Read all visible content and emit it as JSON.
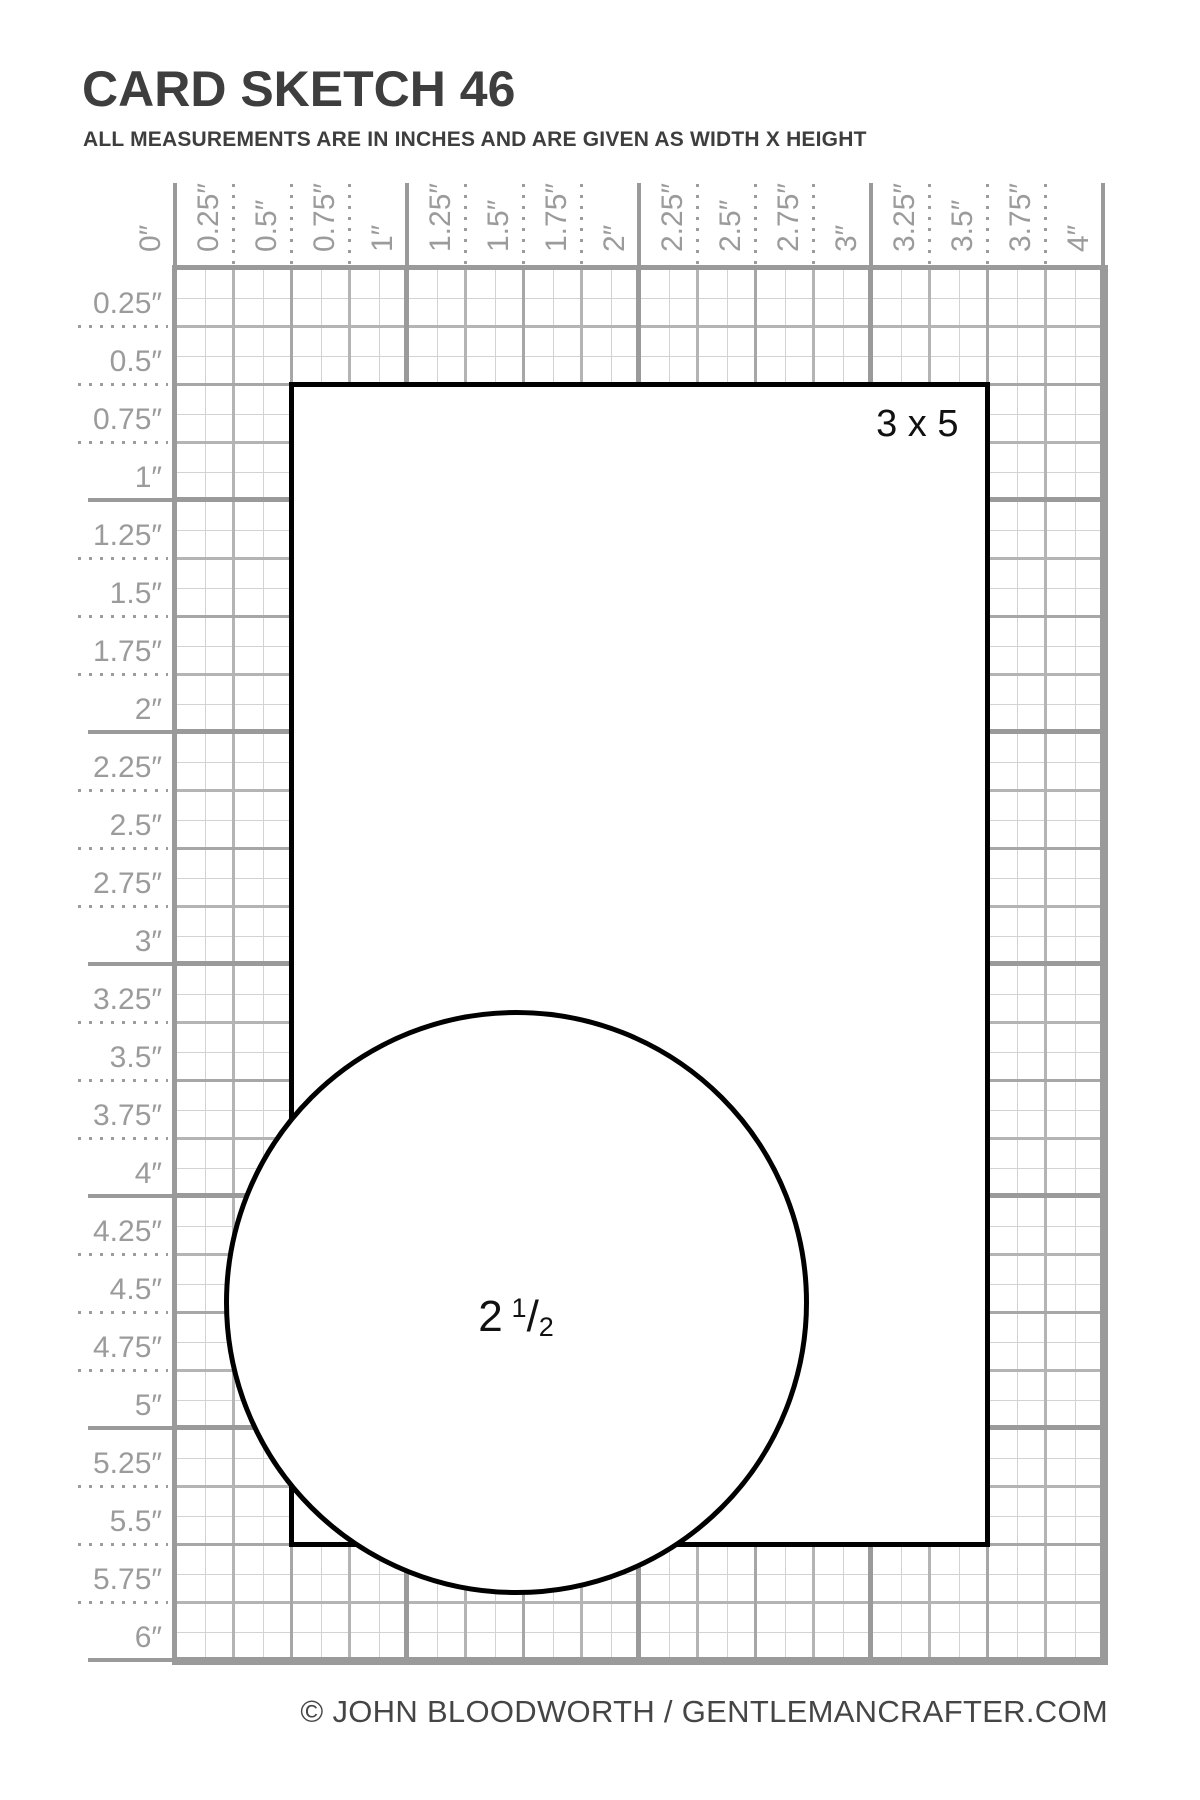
{
  "title": "CARD SKETCH 46",
  "subtitle": "ALL MEASUREMENTS ARE IN INCHES AND ARE GIVEN AS WIDTH X HEIGHT",
  "footer": "© JOHN BLOODWORTH / GENTLEMANCRAFTER.COM",
  "ruler": {
    "unit": "inches",
    "top_labels": [
      "0″",
      "0.25″",
      "0.5″",
      "0.75″",
      "1″",
      "1.25″",
      "1.5″",
      "1.75″",
      "2″",
      "2.25″",
      "2.5″",
      "2.75″",
      "3″",
      "3.25″",
      "3.5″",
      "3.75″",
      "4″"
    ],
    "left_labels": [
      "0.25″",
      "0.5″",
      "0.75″",
      "1″",
      "1.25″",
      "1.5″",
      "1.75″",
      "2″",
      "2.25″",
      "2.5″",
      "2.75″",
      "3″",
      "3.25″",
      "3.5″",
      "3.75″",
      "4″",
      "4.25″",
      "4.5″",
      "4.75″",
      "5″",
      "5.25″",
      "5.5″",
      "5.75″",
      "6″"
    ],
    "grid_width_in": 4,
    "grid_height_in": 6,
    "minor_step_in": 0.125,
    "label_step_in": 0.25
  },
  "shapes": {
    "card": {
      "label": "3 x 5",
      "x_in": 0.5,
      "y_in": 0.5,
      "width_in": 3,
      "height_in": 5
    },
    "circle": {
      "label": "2 1/2",
      "whole": "2",
      "numerator": "1",
      "denominator": "2",
      "center_x_in": 1.47,
      "center_y_in": 4.46,
      "diameter_in": 2.5
    }
  },
  "colors": {
    "grid_major": "#9a9a9a",
    "grid_half": "#a7a7a7",
    "grid_quarter": "#b4b4b4",
    "grid_minor": "#d3d3d3",
    "ruler_text": "#9b9b9b",
    "shape_stroke": "#000000",
    "heading_text": "#3e3e3e",
    "footer_text": "#454545"
  }
}
